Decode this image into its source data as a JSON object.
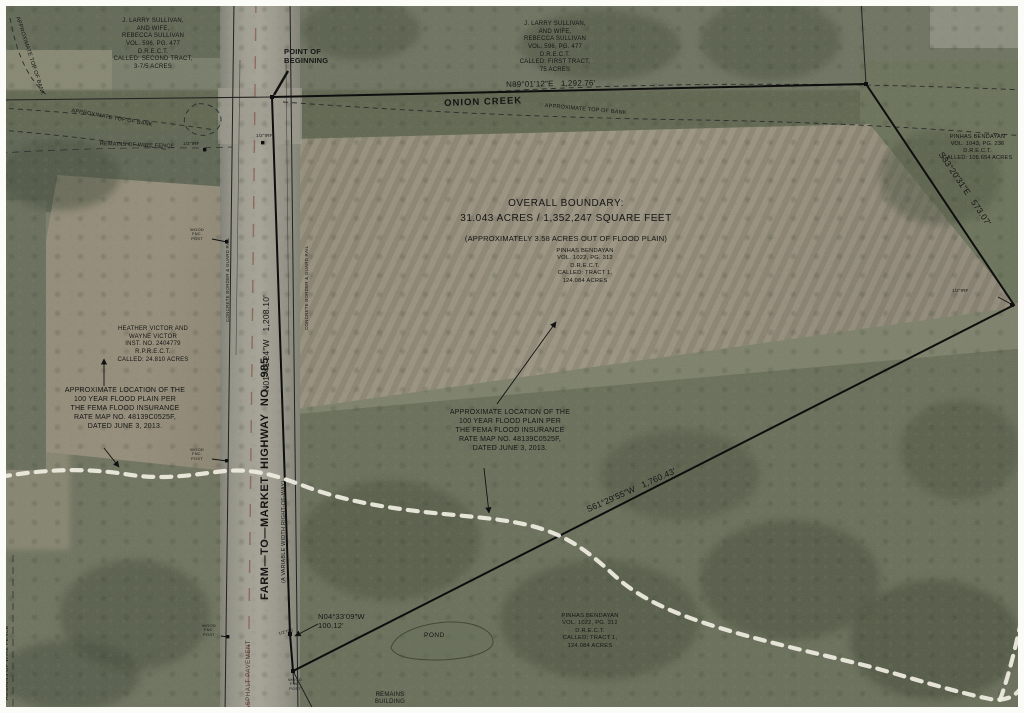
{
  "labels": {
    "point_of_beginning": "POINT OF\nBEGINNING",
    "onion_creek": "ONION CREEK",
    "approx_top_of_bank": "APPROXIMATE TOP OF BANK",
    "remains_wire_fence": "REMAINS OF WIRE FENCE",
    "overall_boundary_line1": "OVERALL BOUNDARY:",
    "overall_boundary_line2": "31.043 ACRES / 1,352,247 SQUARE FEET",
    "flood_plain_note": "(APPROXIMATELY 3.58 ACRES OUT OF FLOOD PLAIN)",
    "flood_location_note": "APPROXIMATE LOCATION OF THE\n100 YEAR FLOOD PLAIN PER\nTHE FEMA FLOOD INSURANCE\nRATE MAP NO. 48139C0525F,\nDATED JUNE 3, 2013.",
    "highway_name": "FARM—TO—MARKET  HIGHWAY  NO.  985",
    "highway_row": "(A VARIABLE WIDTH RIGHT-OF-WAY)",
    "concrete_border": "CONCRETE BORDER & GUARD RAIL",
    "asphalt_pavement": "ASPHALT PAVEMENT",
    "pond": "POND",
    "remains_building": "REMAINS\nBUILDING"
  },
  "bearings": {
    "north_line": "N89°01'12\"E   1,292.76'",
    "east_line": "S33°20'31\"E   573.07'",
    "south_line": "S61°29'55\"W   1,760.43'",
    "west_line": "N01°41'24\"W   1,208.10'",
    "west_short_line": "N04°33'09\"W\n100.12'"
  },
  "parcels": {
    "sullivan_second_tract": "J. LARRY SULLIVAN,\nAND WIFE,\nREBECCA SULLIVAN\nVOL. 596, PG. 477\nD.R.E.C.T.\nCALLED: SECOND TRACT,\n3-7/5 ACRES",
    "sullivan_first_tract": "J. LARRY SULLIVAN,\nAND WIFE,\nREBECCA SULLIVAN\nVOL. 596, PG. 477\nD.R.E.C.T.\nCALLED: FIRST TRACT,\n75 ACRES",
    "bendayan_108": "PINHAS BENDAYAN\nVOL. 1043, PG. 236\nD.R.E.C.T.\nCALLED: 108.654 ACRES",
    "bendayan_tract1": "PINHAS BENDAYAN\nVOL. 1022, PG. 312\nD.R.E.C.T.\nCALLED: TRACT 1,\n124.084 ACRES",
    "victor": "HEATHER VICTOR AND\nWAYNE VICTOR\nINST. NO. 2404779\nR.P.R.E.C.T.\nCALLED: 24.810 ACRES"
  },
  "monuments": {
    "irf": "1/2\"IRF",
    "irs": "1/2\"IRS",
    "wood_post": "WOOD\nFNC.\nPOST"
  },
  "colors": {
    "survey_line": "#111111",
    "flood_dash": "#edeade",
    "label_text": "#151515"
  }
}
